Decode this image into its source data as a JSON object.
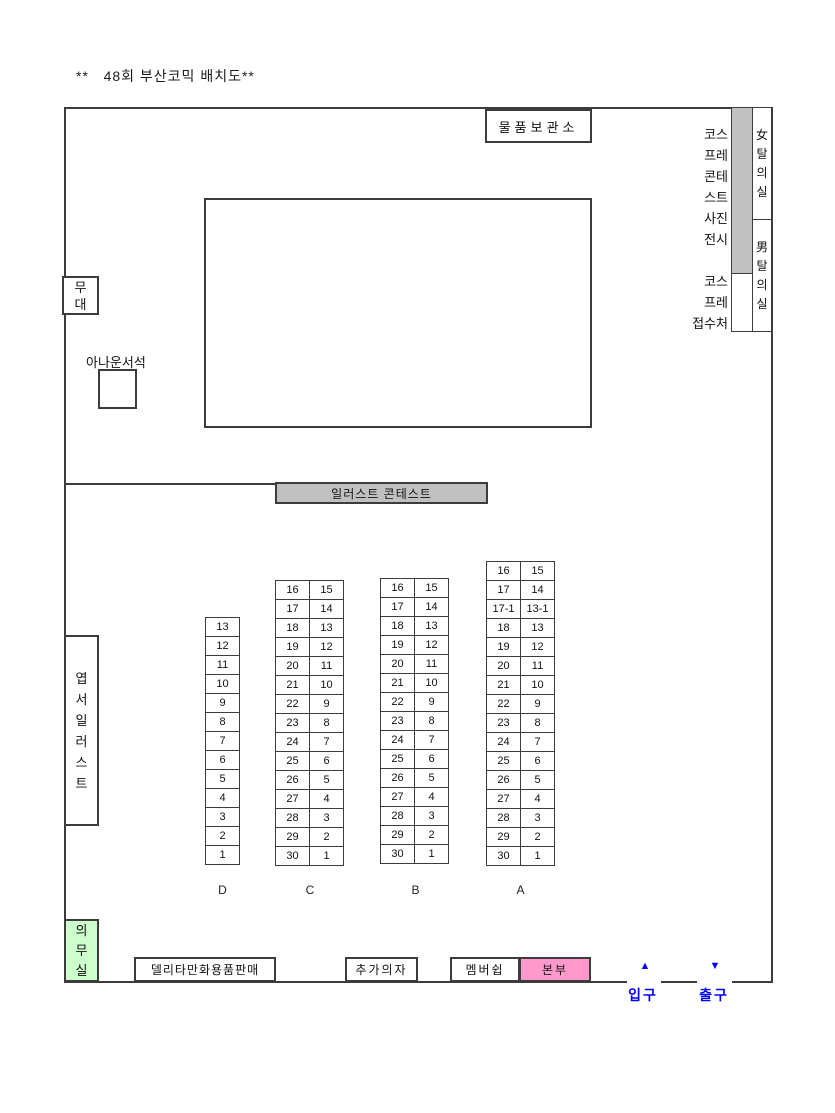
{
  "title": "**   48회 부산코믹 배치도**",
  "colors": {
    "wall": "#3c3c3c",
    "gray": "#c0c0c0",
    "green": "#ccffcc",
    "pink": "#ff99cc",
    "blue": "#0000ff"
  },
  "areas": {
    "storage": {
      "label": "물품보관소"
    },
    "cosplay_exhibit": {
      "lines": "코스\n프레\n콘테\n스트\n사진\n전시"
    },
    "cosplay_reception": {
      "lines": "코스\n프레\n접수처"
    },
    "women_changing": {
      "lines": "女\n탈\n의\n실"
    },
    "men_changing": {
      "lines": "男\n탈\n의\n실"
    },
    "stage": {
      "lines": "무\n대"
    },
    "announcer": {
      "label": "아나운서석"
    },
    "illust_contest": {
      "label": "일러스트 콘테스트"
    },
    "postcard_illust": {
      "lines": "엽\n서\n일\n러\n스\n트"
    },
    "first_aid": {
      "lines": "의\n무\n실"
    },
    "delita_sales": {
      "label": "델리타만화용품판매"
    },
    "extra_chairs": {
      "label": "추가의자"
    },
    "membership": {
      "label": "멤버쉽"
    },
    "headquarters": {
      "label": "본부"
    },
    "entrance": {
      "label": "입구",
      "arrow": "▲"
    },
    "exit": {
      "label": "출구",
      "arrow": "▼"
    }
  },
  "seating": {
    "columns": [
      {
        "id": "D",
        "label": "D",
        "subcols": [
          [
            "13",
            "12",
            "11",
            "10",
            "9",
            "8",
            "7",
            "6",
            "5",
            "4",
            "3",
            "2",
            "1"
          ]
        ]
      },
      {
        "id": "C",
        "label": "C",
        "subcols": [
          [
            "16",
            "17",
            "18",
            "19",
            "20",
            "21",
            "22",
            "23",
            "24",
            "25",
            "26",
            "27",
            "28",
            "29",
            "30"
          ],
          [
            "15",
            "14",
            "13",
            "12",
            "11",
            "10",
            "9",
            "8",
            "7",
            "6",
            "5",
            "4",
            "3",
            "2",
            "1"
          ]
        ]
      },
      {
        "id": "B",
        "label": "B",
        "subcols": [
          [
            "16",
            "17",
            "18",
            "19",
            "20",
            "21",
            "22",
            "23",
            "24",
            "25",
            "26",
            "27",
            "28",
            "29",
            "30"
          ],
          [
            "15",
            "14",
            "13",
            "12",
            "11",
            "10",
            "9",
            "8",
            "7",
            "6",
            "5",
            "4",
            "3",
            "2",
            "1"
          ]
        ]
      },
      {
        "id": "A",
        "label": "A",
        "subcols": [
          [
            "16",
            "17",
            "17-1",
            "18",
            "19",
            "20",
            "21",
            "22",
            "23",
            "24",
            "25",
            "26",
            "27",
            "28",
            "29",
            "30"
          ],
          [
            "15",
            "14",
            "13-1",
            "13",
            "12",
            "11",
            "10",
            "9",
            "8",
            "7",
            "6",
            "5",
            "4",
            "3",
            "2",
            "1"
          ]
        ]
      }
    ]
  }
}
